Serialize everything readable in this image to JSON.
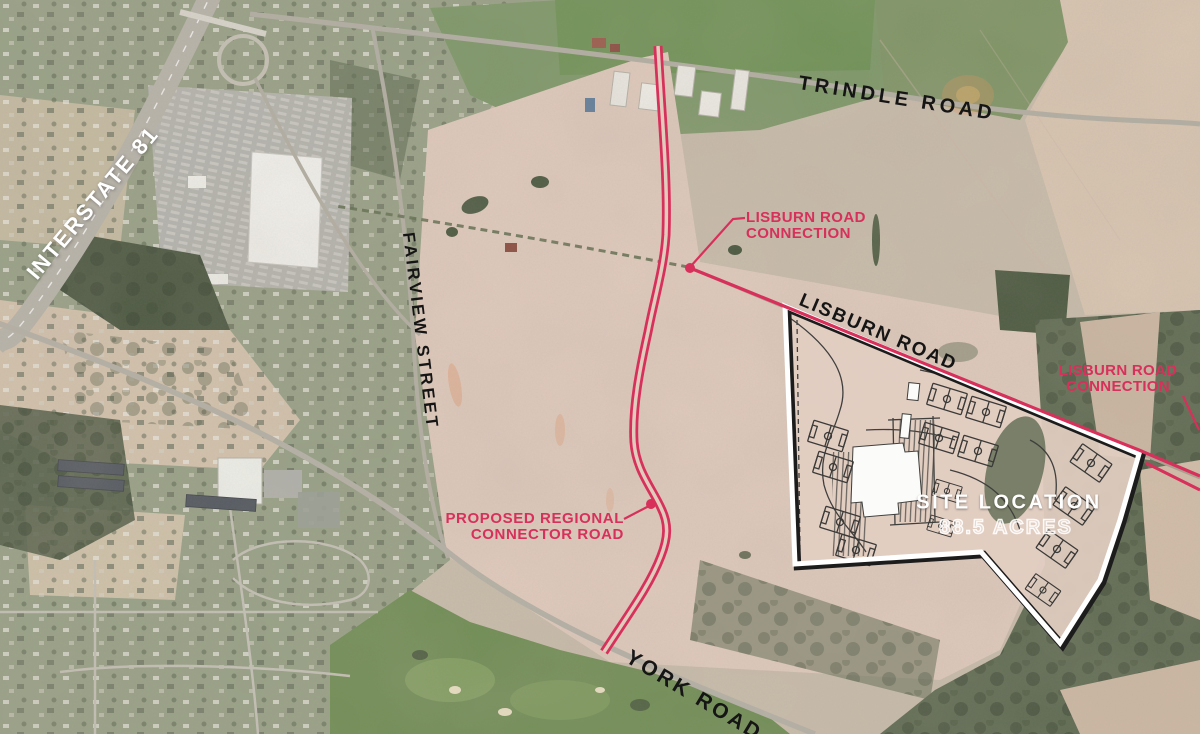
{
  "labels": {
    "interstate": "INTERSTATE 81",
    "trindle": "TRINDLE ROAD",
    "fairview": "FAIRVIEW STREET",
    "lisburn": "LISBURN ROAD",
    "york": "YORK ROAD"
  },
  "annotations": {
    "lisburn_connection_center": {
      "line1": "LISBURN ROAD",
      "line2": "CONNECTION"
    },
    "lisburn_connection_east": {
      "line1": "LISBURN ROAD",
      "line2": "CONNECTION"
    },
    "proposed_connector": {
      "line1": "PROPOSED REGIONAL",
      "line2": "CONNECTOR ROAD"
    },
    "site": {
      "title": "SITE LOCATION",
      "acreage": "88.5 ACRES"
    }
  },
  "colors": {
    "annotation_pink": "#d7305a",
    "road_label_black": "#151515",
    "site_label_white": "#ffffff",
    "field_tan": "#e0cbbd",
    "forest_green": "#5c6950"
  }
}
